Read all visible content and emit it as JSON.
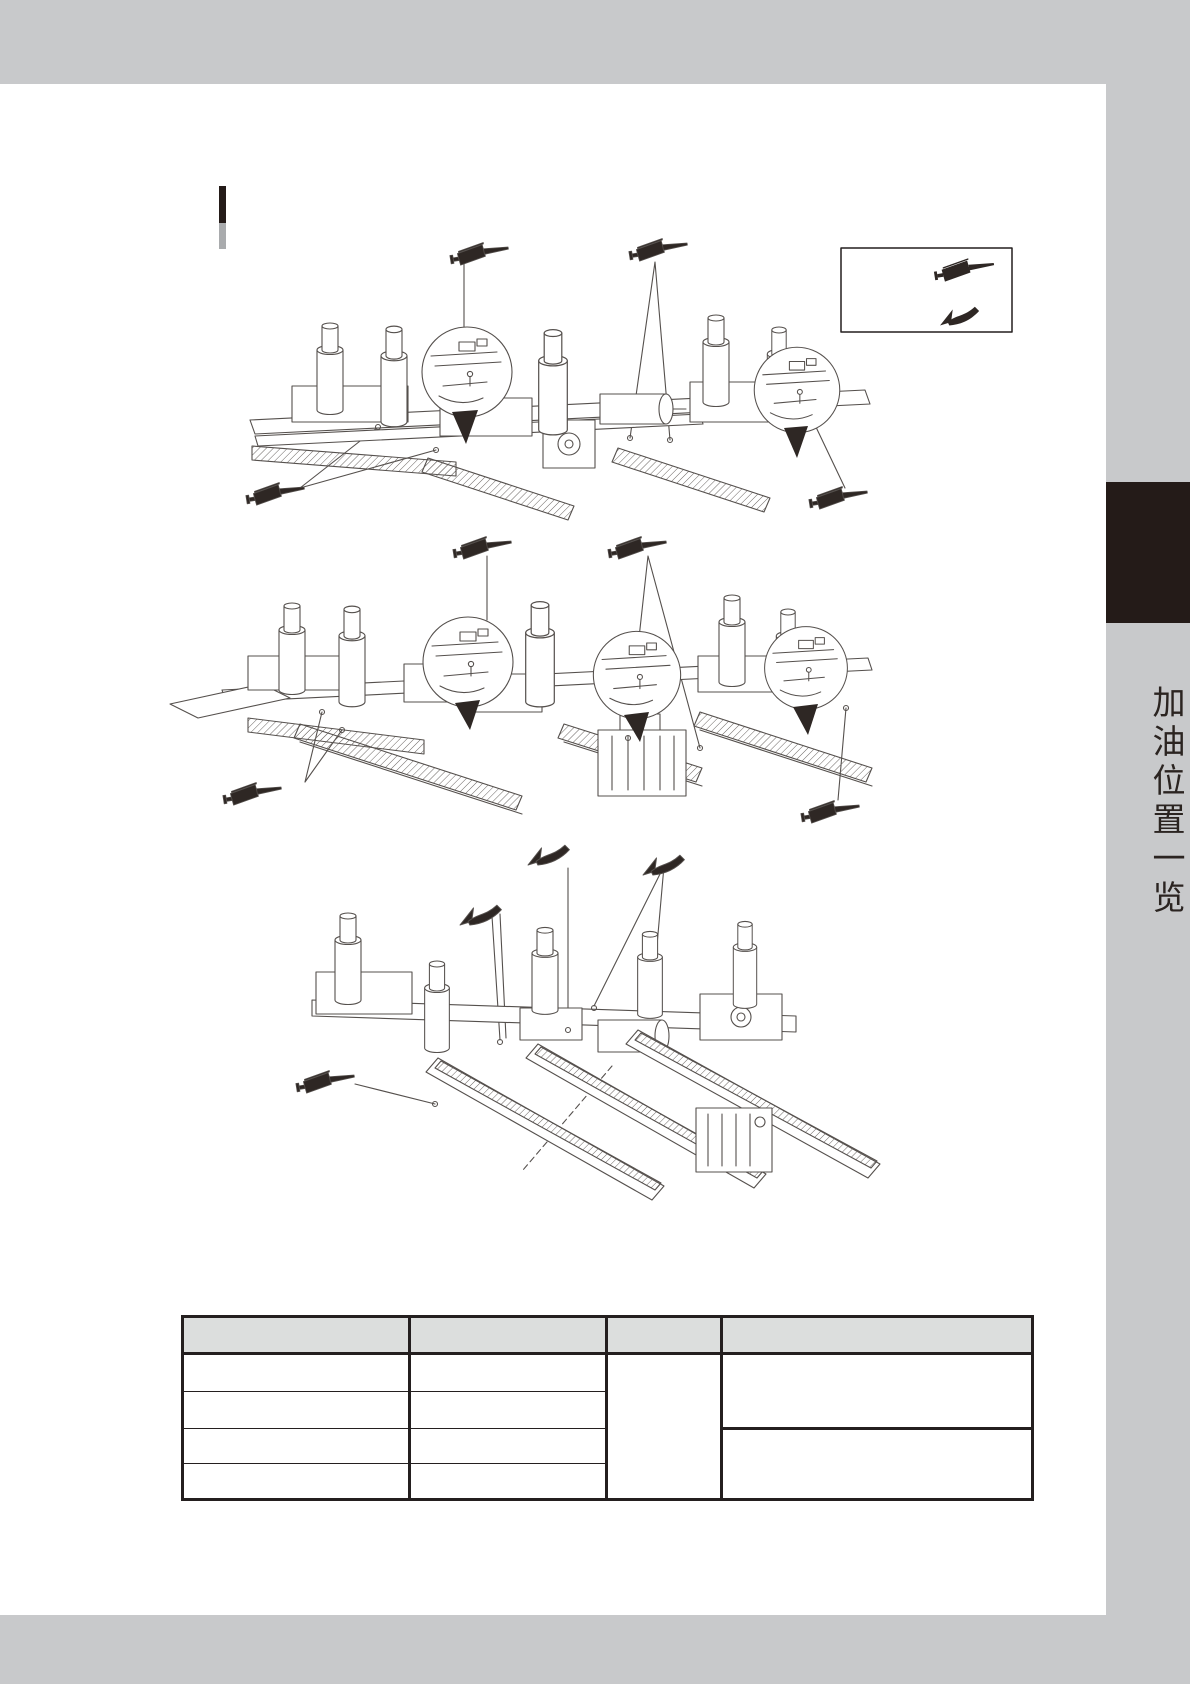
{
  "page": {
    "background": "#ffffff",
    "band_color": "#c8c9cb",
    "footer_band": "",
    "header_band": ""
  },
  "sidebar": {
    "tab_color": "#241b18",
    "title": "加油位置一览",
    "title_color": "#2b2421"
  },
  "section_heading": {
    "text": "",
    "marker_top_color": "#241b18",
    "marker_bottom_color": "#a9abad"
  },
  "legend": {
    "border_color": "#241f1f",
    "items": [
      {
        "icon": "grease-gun-icon",
        "label": ""
      },
      {
        "icon": "curved-arrow-icon",
        "label": ""
      }
    ]
  },
  "icons": {
    "grease_gun": {
      "name": "grease-gun-icon",
      "color": "#2e2724"
    },
    "curved_arrow": {
      "name": "curved-arrow-icon",
      "color": "#2e2724"
    }
  },
  "diagrams": [
    {
      "name": "top-machine-oiling-diagram",
      "grease_gun_icons": 4,
      "callout_circles": 2,
      "curved_arrow_icons": 0
    },
    {
      "name": "middle-machine-oiling-diagram",
      "grease_gun_icons": 4,
      "callout_circles": 3,
      "curved_arrow_icons": 0
    },
    {
      "name": "bottom-machine-oiling-diagram",
      "grease_gun_icons": 1,
      "callout_circles": 0,
      "curved_arrow_icons": 3
    }
  ],
  "table": {
    "header_bg": "#dcdedd",
    "header": [
      "",
      "",
      "",
      ""
    ],
    "col1_rows": [
      "",
      "",
      "",
      ""
    ],
    "col2_rows": [
      "",
      "",
      "",
      ""
    ],
    "col3_merged": "",
    "col4_cells": [
      "",
      ""
    ]
  }
}
